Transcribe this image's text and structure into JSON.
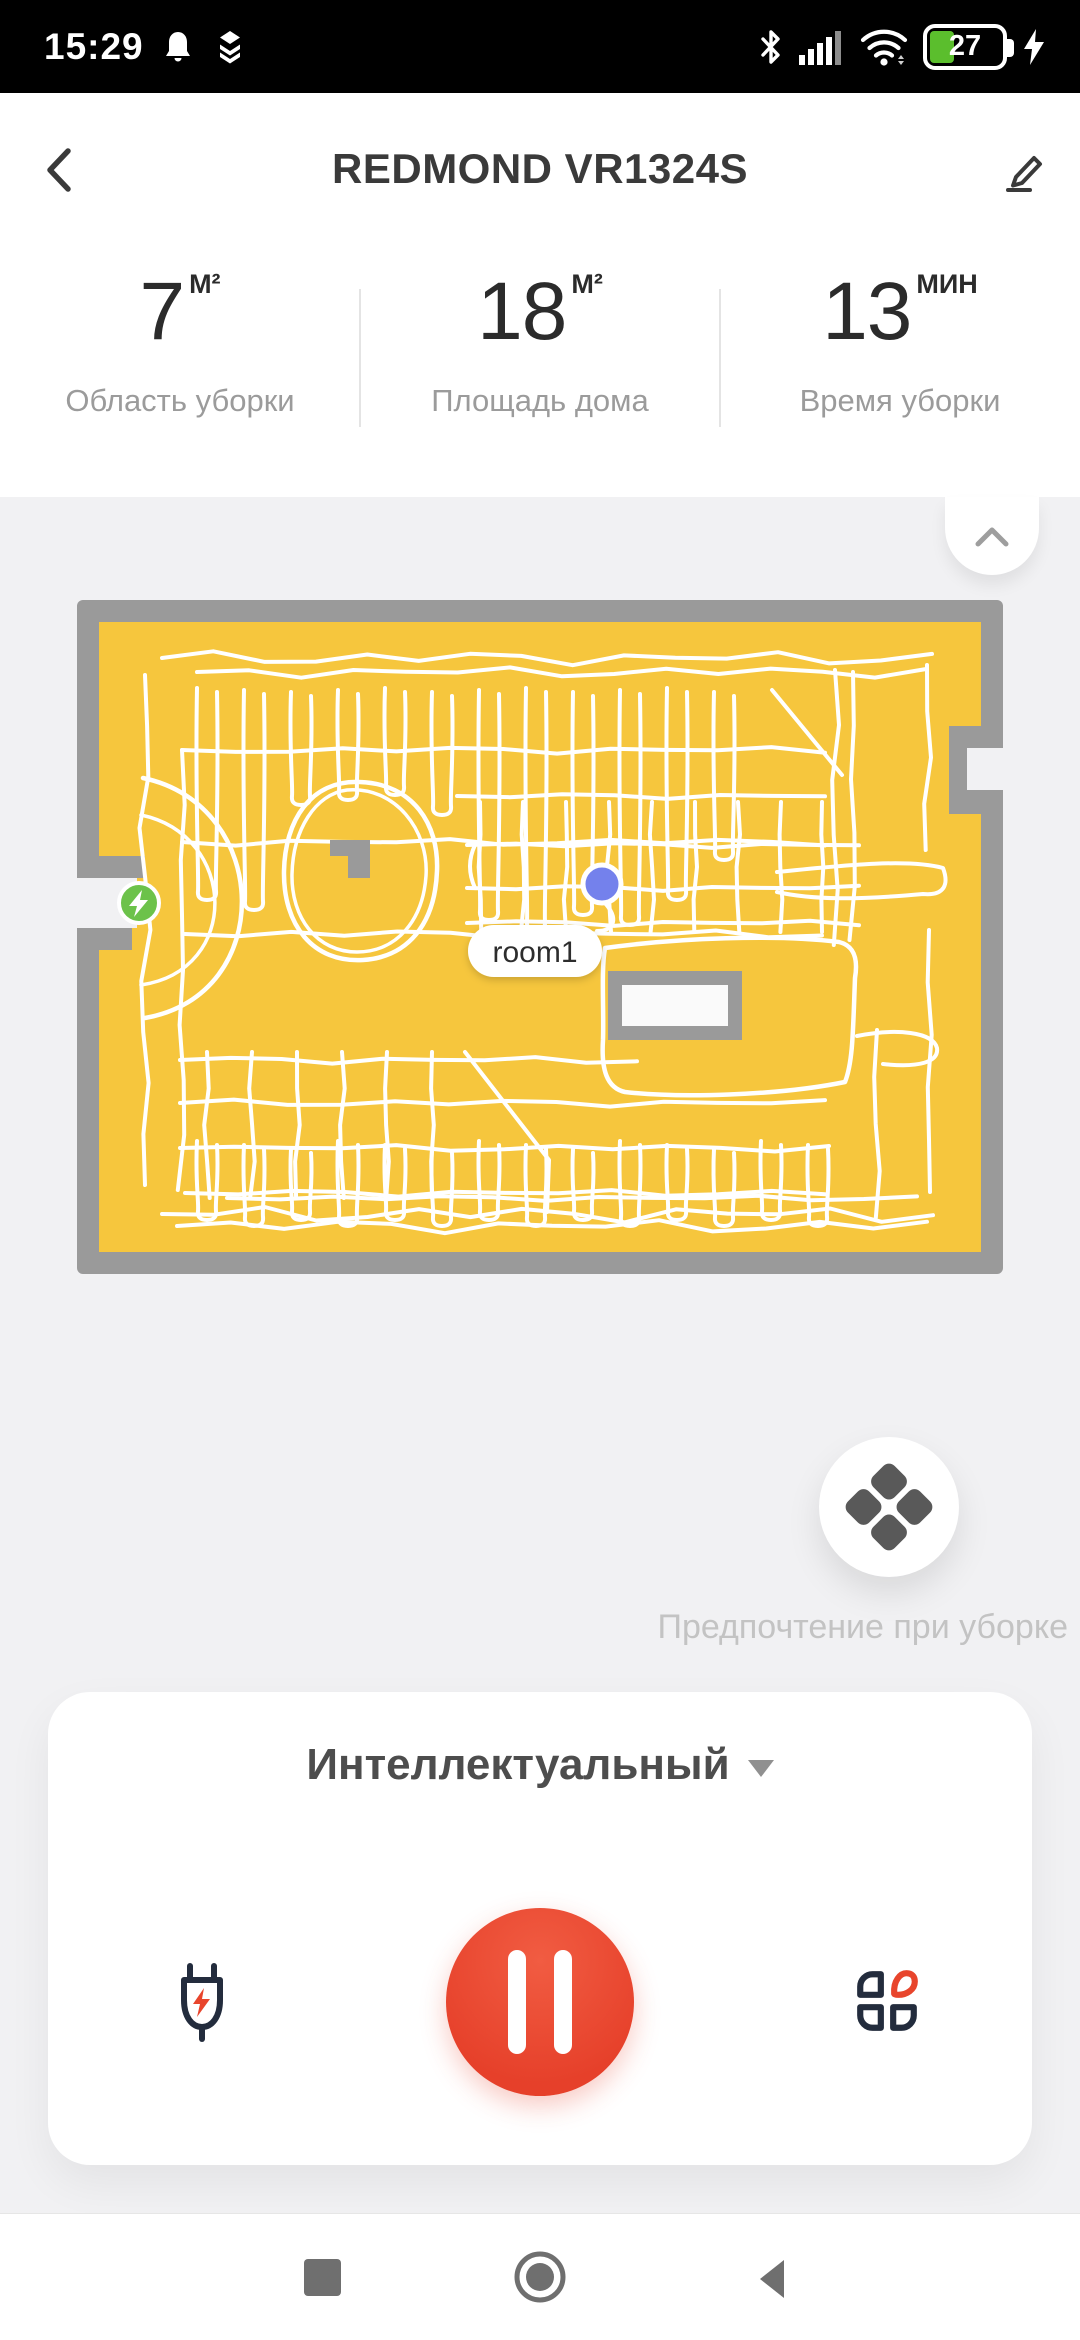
{
  "status_bar": {
    "time": "15:29",
    "battery_percent": "27",
    "icons": [
      "bell-icon",
      "layers-icon",
      "bluetooth-icon",
      "signal-icon",
      "wifi-icon",
      "battery-icon",
      "charging-bolt-icon"
    ]
  },
  "header": {
    "title": "REDMOND VR1324S"
  },
  "stats": {
    "items": [
      {
        "value": "7",
        "unit": "М²",
        "label": "Область уборки"
      },
      {
        "value": "18",
        "unit": "М²",
        "label": "Площадь дома"
      },
      {
        "value": "13",
        "unit": "МИН",
        "label": "Время уборки"
      }
    ]
  },
  "map": {
    "room_label": "room1",
    "floor_color": "#F6C63D",
    "wall_color": "#9A9A9A",
    "path_color": "#FFFFFF",
    "robot_color": "#7481EC",
    "dock_color": "#6CC24A"
  },
  "preference": {
    "label": "Предпочтение при уборке"
  },
  "controls": {
    "mode": "Интеллектуальный",
    "accent_red": "#E6402A",
    "icon_navy": "#232C3D",
    "buttons": [
      "recharge-button",
      "pause-button",
      "rooms-button"
    ]
  }
}
